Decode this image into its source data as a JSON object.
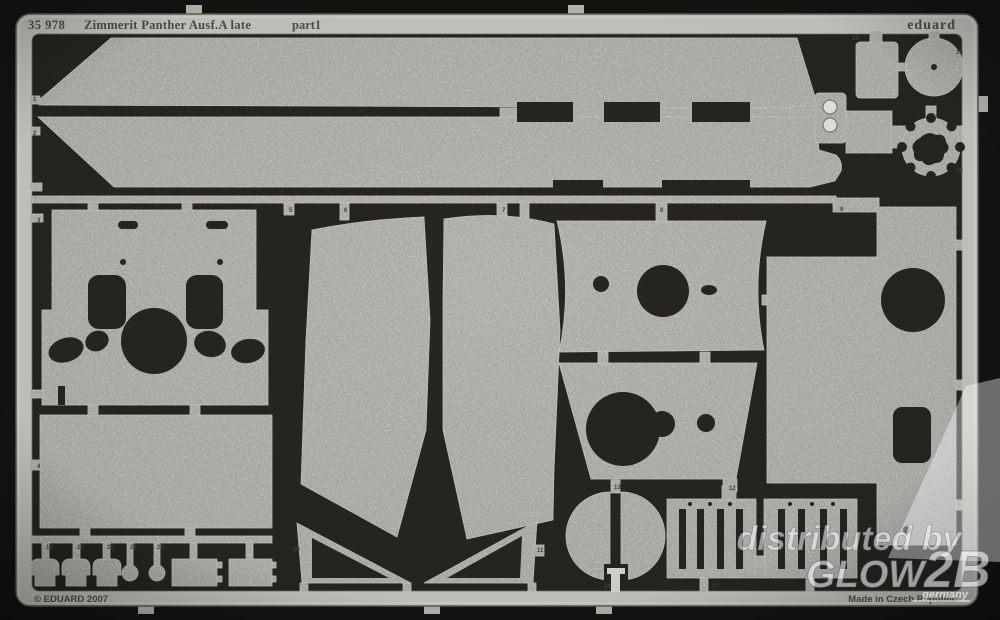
{
  "sheet": {
    "catalog_number": "35 978",
    "title": "Zimmerit Panther Ausf.A late",
    "part_label": "part1",
    "brand": "eduard",
    "copyright": "© EDUARD 2007",
    "made_in": "Made in Czech Republic"
  },
  "watermark": {
    "line1": "distributed by",
    "brand": "GLOW",
    "brand2": "2B",
    "country": "germany"
  },
  "colors": {
    "photo_background": "#151412",
    "fret_interior": "#262521",
    "metal_frame": "#c7c7c1",
    "metal_part": "#d8d8d3",
    "etched_text": "#4e4d46",
    "watermark_white": "#ffffff"
  },
  "part_labels": [
    "1",
    "2",
    "3",
    "4",
    "5",
    "6",
    "7",
    "8",
    "9",
    "10",
    "11",
    "12",
    "13",
    "14",
    "15",
    "16",
    "17",
    "18",
    "19",
    "20",
    "21",
    "22",
    "23",
    "26"
  ]
}
